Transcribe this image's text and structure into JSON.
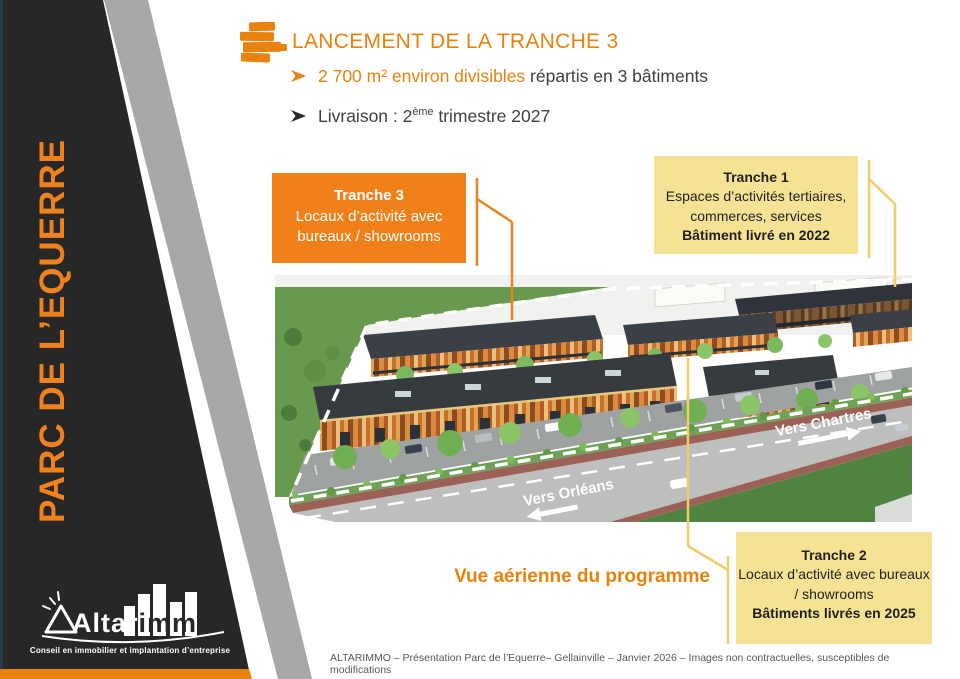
{
  "colors": {
    "accent_orange": "#E8820C",
    "box_orange": "#F08019",
    "box_yellow": "#F6E294",
    "connector_gold": "#F2CC6B",
    "panel_black": "#272727",
    "panel_gray": "#A8A8A8"
  },
  "sidebar": {
    "title": "PARC DE L’EQUERRE"
  },
  "header": {
    "title": "LANCEMENT DE LA TRANCHE 3"
  },
  "bullets": {
    "b1_highlight": "2 700 m² environ divisibles",
    "b1_rest": " répartis en 3 bâtiments",
    "b2_pre": "Livraison : 2",
    "b2_sup": "ème",
    "b2_post": " trimestre 2027"
  },
  "callouts": {
    "tranche3": {
      "title": "Tranche 3",
      "body": "Locaux d’activité avec bureaux / showrooms"
    },
    "tranche1": {
      "title": "Tranche 1",
      "body": "Espaces d’activités tertiaires, commerces, services",
      "delivery": "Bâtiment livré en 2022"
    },
    "tranche2": {
      "title": "Tranche 2",
      "body": "Locaux d’activité avec bureaux / showrooms",
      "delivery": "Bâtiments livrés en 2025"
    }
  },
  "image": {
    "caption": "Vue aérienne du programme",
    "road_label_left": "Vers Orléans",
    "road_label_right": "Vers Chartres"
  },
  "logo": {
    "name_left": "Altar",
    "name_right": "immo",
    "tagline": "Conseil en immobilier et implantation d’entreprise"
  },
  "footer": {
    "text": "ALTARIMMO – Présentation  Parc de l’Equerre– Gellainville – Janvier 2026 – Images non contractuelles, susceptibles de modifications"
  }
}
